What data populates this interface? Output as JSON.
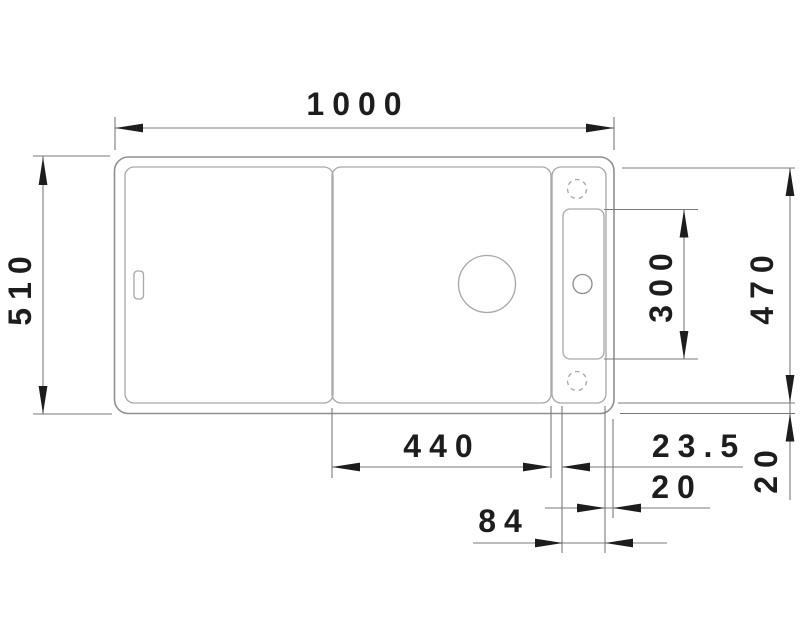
{
  "drawing": {
    "kind": "sink top-view dimension drawing",
    "labels": {
      "overall_width": "1000",
      "overall_depth": "510",
      "right_inner_depth": "470",
      "rail_length": "300",
      "bowl_width": "440",
      "bowl_to_rail": "23.5",
      "rail_to_edge": "20",
      "rail_width": "84",
      "bottom_edge_inset": "20"
    },
    "colors": {
      "background": "#ffffff",
      "outline_outer": "#8f8f8f",
      "outline_inner": "#a9a9a9",
      "dim_line": "#7a7a7a",
      "ink": "#1d1d1d"
    }
  }
}
